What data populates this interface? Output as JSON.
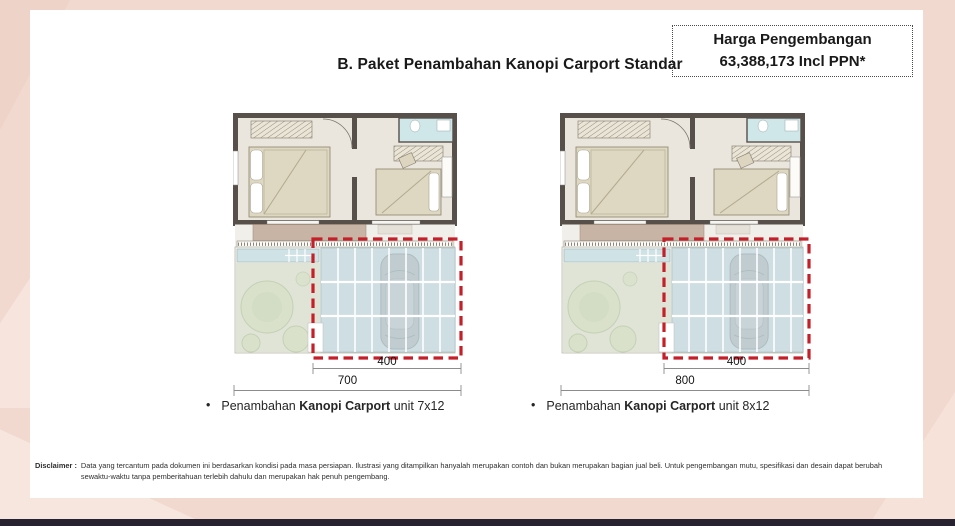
{
  "colors": {
    "background": "#f1d9cf",
    "card": "#ffffff",
    "bottom_bar": "#26222f",
    "accent_red": "#c5202a",
    "wall": "#57504a",
    "floor": "#eae6de",
    "terrace": "#c8b4a5",
    "bathroom": "#cfe7e9",
    "garden": "#dfe4d7",
    "pool": "#cfe2e6",
    "canopy_glass": "#cbdce1"
  },
  "header": {
    "title": "B. Paket Penambahan Kanopi Carport Standar",
    "price_box": {
      "line1": "Harga Pengembangan",
      "line2": "63,388,173 Incl PPN*"
    }
  },
  "plans": [
    {
      "name": "kanopi-carport-7x12",
      "inner_dim": "400",
      "outer_dim": "700",
      "caption": {
        "bullet": "•",
        "prefix": "Penambahan ",
        "bold": "Kanopi Carport",
        "suffix": " unit 7x12"
      }
    },
    {
      "name": "kanopi-carport-8x12",
      "inner_dim": "400",
      "outer_dim": "800",
      "caption": {
        "bullet": "•",
        "prefix": "Penambahan ",
        "bold": "Kanopi Carport",
        "suffix": " unit 8x12"
      }
    }
  ],
  "disclaimer": {
    "label": "Disclaimer :",
    "text": "Data yang tercantum pada dokumen ini berdasarkan kondisi pada masa persiapan. Ilustrasi yang ditampilkan hanyalah merupakan contoh dan bukan merupakan bagian jual beli. Untuk pengembangan mutu, spesifikasi dan desain dapat berubah sewaktu-waktu tanpa pemberitahuan terlebih dahulu dan merupakan hak penuh pengembang."
  }
}
